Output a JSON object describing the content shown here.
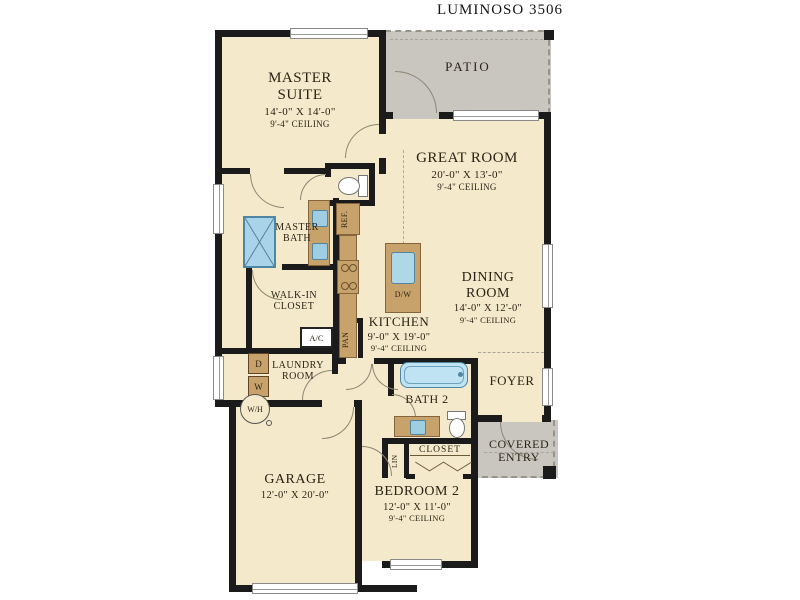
{
  "title": "LUMINOSO 3506",
  "rooms": {
    "master_suite": {
      "name": "MASTER SUITE",
      "dims": "14'-0\" X 14'-0\"",
      "ceiling": "9'-4\" CEILING"
    },
    "patio": {
      "name": "PATIO"
    },
    "great_room": {
      "name": "GREAT ROOM",
      "dims": "20'-0\" X 13'-0\"",
      "ceiling": "9'-4\" CEILING"
    },
    "dining_room": {
      "name": "DINING ROOM",
      "dims": "14'-0\" X 12'-0\"",
      "ceiling": "9'-4\" CEILING"
    },
    "master_bath": {
      "name": "MASTER BATH"
    },
    "walk_in_closet": {
      "name": "WALK-IN CLOSET"
    },
    "kitchen": {
      "name": "KITCHEN",
      "dims": "9'-0\" X 19'-0\"",
      "ceiling": "9'-4\" CEILING"
    },
    "laundry_room": {
      "name": "LAUNDRY ROOM"
    },
    "bath_2": {
      "name": "BATH 2"
    },
    "foyer": {
      "name": "FOYER"
    },
    "covered_entry": {
      "name": "COVERED ENTRY"
    },
    "garage": {
      "name": "GARAGE",
      "dims": "12'-0\" X 20'-0\""
    },
    "bedroom_2": {
      "name": "BEDROOM 2",
      "dims": "12'-0\" X 11'-0\"",
      "ceiling": "9'-4\" CEILING"
    }
  },
  "fixtures": {
    "refrigerator": "REF.",
    "dishwasher": "D/W",
    "air_conditioner": "A/C",
    "pantry": "PAN",
    "dryer": "D",
    "washer": "W",
    "water_heater": "W/H",
    "linen": "LIN",
    "closet": "CLOSET"
  },
  "colors": {
    "floor": "#f4e9cb",
    "outdoor": "#c9c6c0",
    "wall": "#1b1b1b",
    "fixture_blue": "#aed7e8",
    "cabinet_brown": "#c7a26b"
  }
}
